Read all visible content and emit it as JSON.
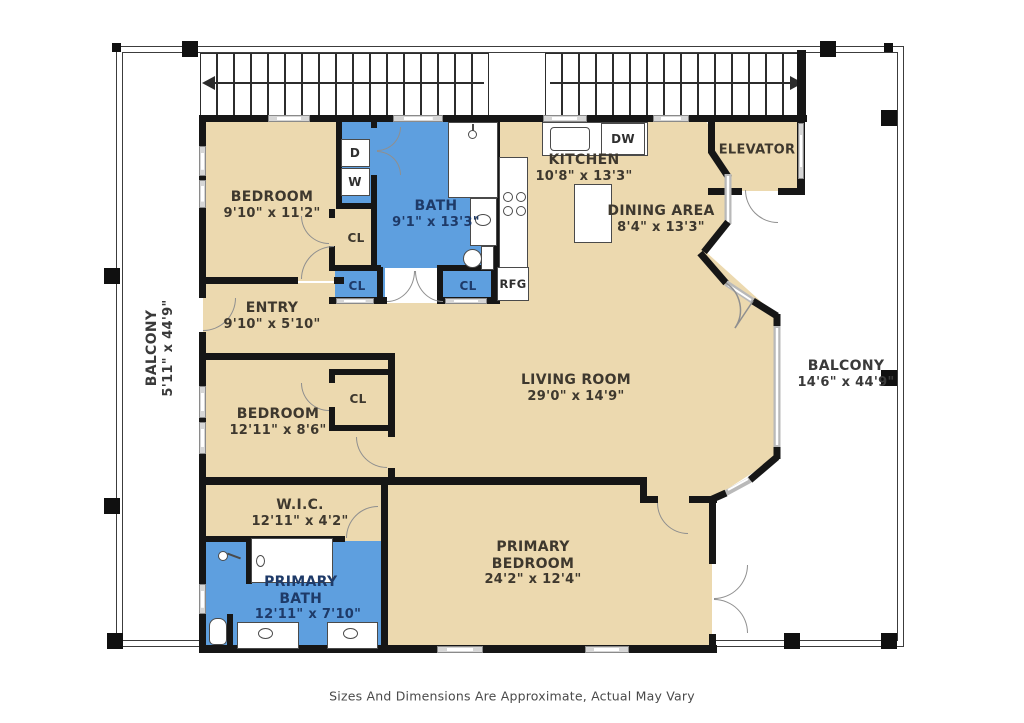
{
  "plan": {
    "rooms": {
      "bedroom_top": {
        "name": "BEDROOM",
        "dims": "9'10\" x 11'2\""
      },
      "bath": {
        "name": "BATH",
        "dims": "9'1\" x 13'3\""
      },
      "kitchen": {
        "name": "KITCHEN",
        "dims": "10'8\" x 13'3\""
      },
      "dining_area": {
        "name": "DINING AREA",
        "dims": "8'4\" x 13'3\""
      },
      "elevator": {
        "name": "ELEVATOR"
      },
      "entry": {
        "name": "ENTRY",
        "dims": "9'10\" x 5'10\""
      },
      "living_room": {
        "name": "LIVING ROOM",
        "dims": "29'0\" x 14'9\""
      },
      "bedroom_middle": {
        "name": "BEDROOM",
        "dims": "12'11\" x 8'6\""
      },
      "wic": {
        "name": "W.I.C.",
        "dims": "12'11\" x 4'2\""
      },
      "primary_bath": {
        "name": "PRIMARY BATH",
        "dims": "12'11\" x 7'10\""
      },
      "primary_bedroom": {
        "name": "PRIMARY BEDROOM",
        "dims": "24'2\" x 12'4\""
      },
      "balcony_left": {
        "name": "BALCONY",
        "dims": "5'11\" x 44'9\""
      },
      "balcony_right": {
        "name": "BALCONY",
        "dims": "14'6\" x 44'9\""
      }
    },
    "fixtures": {
      "closet": "CL",
      "dryer": "D",
      "washer": "W",
      "dishwasher": "DW",
      "refrigerator": "RFG"
    },
    "footer": {
      "disclaimer": "Sizes And Dimensions Are Approximate, Actual May Vary"
    },
    "colors": {
      "room_fill": "#ecd9af",
      "wet_fill": "#5e9fdf",
      "wall": "#161616",
      "window": "#d6d6d6",
      "label_dark": "#3e382e",
      "label_blue": "#1e3a68"
    }
  }
}
